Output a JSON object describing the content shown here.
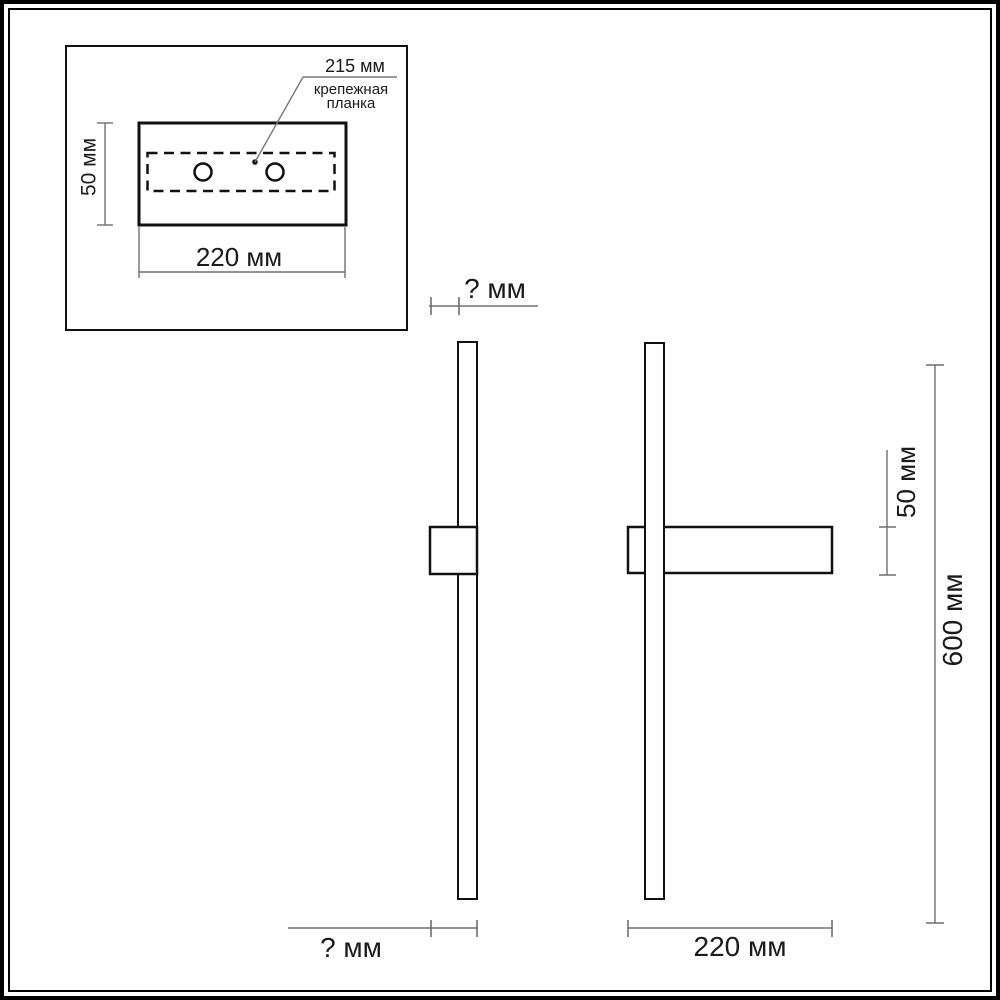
{
  "drawing": {
    "type": "wall-lamp installation dimensions",
    "inset": {
      "leader_label": "215 мм",
      "mount_plate_line1": "крепежная",
      "mount_plate_line2": "планка",
      "height_label": "50 мм",
      "width_label": "220 мм"
    },
    "side_view": {
      "depth_top_label": "? мм",
      "depth_bottom_label": "? мм"
    },
    "front_view": {
      "plate_height_label": "50 мм",
      "total_height_label": "600 мм",
      "plate_width_label": "220 мм"
    },
    "colors": {
      "outline": "#111111",
      "dimension_line": "#6e6e6e",
      "background": "#ffffff"
    }
  }
}
